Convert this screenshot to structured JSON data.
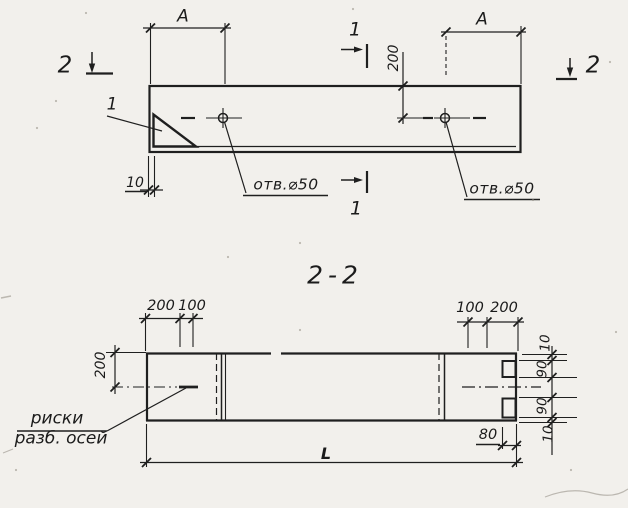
{
  "top_view": {
    "dim_a_left": "A",
    "dim_a_right": "A",
    "dim_200_vertical": "200",
    "dim_10": "10",
    "hole_label_left": "отв.⌀50",
    "hole_label_right": "отв.⌀50",
    "detail_label": "1",
    "section1_top": "1",
    "section1_bottom": "1",
    "section2_left": "2",
    "section2_right": "2"
  },
  "section_view": {
    "title": "2-2",
    "dim_200_top_left": "200",
    "dim_100_top_left": "100",
    "dim_100_top_right": "100",
    "dim_200_top_right": "200",
    "dim_200_left": "200",
    "dim_right_10_top": "10",
    "dim_right_90_top": "90",
    "dim_right_90_bottom": "90",
    "dim_right_10_bottom": "10",
    "dim_80": "80",
    "dim_length": "L",
    "note_line1": "риски",
    "note_line2": "разб. осей"
  },
  "colors": {
    "paper": "#f2f0ec",
    "ink": "#1f1f1f"
  }
}
